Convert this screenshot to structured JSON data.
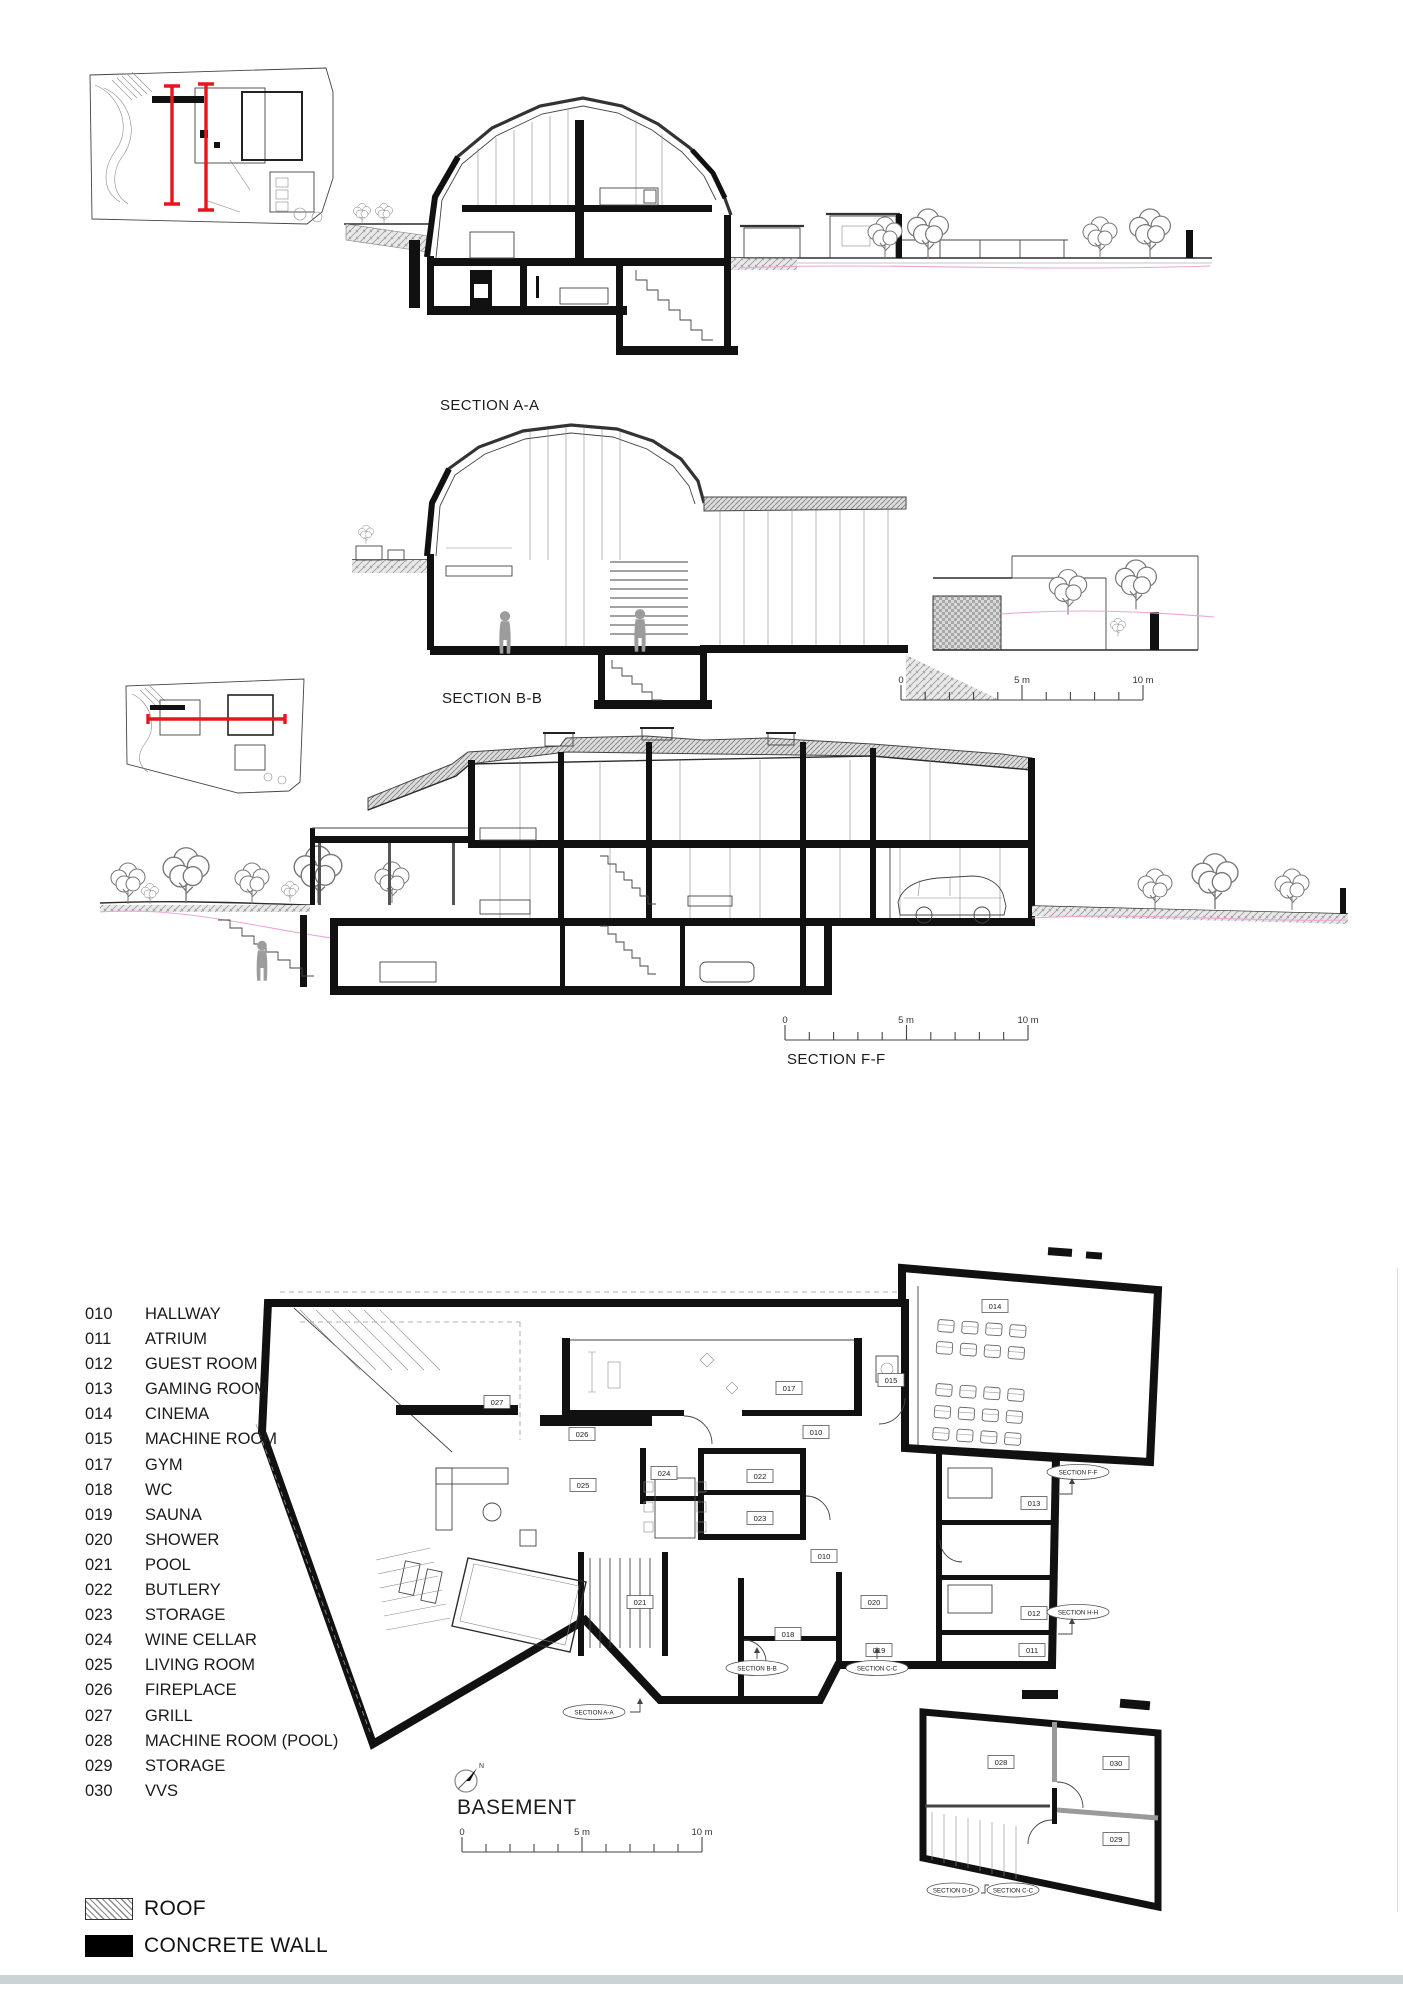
{
  "sections": {
    "aa": {
      "label": "SECTION A-A"
    },
    "bb": {
      "label": "SECTION B-B"
    },
    "ff": {
      "label": "SECTION F-F"
    }
  },
  "scale_bar": {
    "zero": "0",
    "five": "5 m",
    "ten": "10 m"
  },
  "basement": {
    "title": "BASEMENT",
    "north": "N",
    "tags": {
      "t010a": "010",
      "t010b": "010",
      "t011": "011",
      "t012": "012",
      "t013": "013",
      "t014": "014",
      "t015": "015",
      "t017": "017",
      "t018": "018",
      "t019": "019",
      "t020": "020",
      "t021": "021",
      "t022": "022",
      "t023": "023",
      "t024": "024",
      "t025": "025",
      "t026": "026",
      "t027": "027",
      "t028": "028",
      "t029": "029",
      "t030": "030"
    },
    "markers": {
      "ff": "SECTION F-F",
      "hh": "SECTION H-H",
      "aa": "SECTION A-A",
      "bb": "SECTION B-B",
      "cc": "SECTION C-C",
      "dd": "SECTION D-D",
      "cc2": "SECTION C-C"
    }
  },
  "legend": {
    "rooms": [
      {
        "code": "010",
        "name": "HALLWAY"
      },
      {
        "code": "011",
        "name": "ATRIUM"
      },
      {
        "code": "012",
        "name": "GUEST ROOM"
      },
      {
        "code": "013",
        "name": "GAMING ROOM"
      },
      {
        "code": "014",
        "name": "CINEMA"
      },
      {
        "code": "015",
        "name": "MACHINE ROOM"
      },
      {
        "code": "017",
        "name": "GYM"
      },
      {
        "code": "018",
        "name": "WC"
      },
      {
        "code": "019",
        "name": "SAUNA"
      },
      {
        "code": "020",
        "name": "SHOWER"
      },
      {
        "code": "021",
        "name": "POOL"
      },
      {
        "code": "022",
        "name": "BUTLERY"
      },
      {
        "code": "023",
        "name": "STORAGE"
      },
      {
        "code": "024",
        "name": "WINE CELLAR"
      },
      {
        "code": "025",
        "name": "LIVING ROOM"
      },
      {
        "code": "026",
        "name": "FIREPLACE"
      },
      {
        "code": "027",
        "name": "GRILL"
      },
      {
        "code": "028",
        "name": "MACHINE ROOM (POOL)"
      },
      {
        "code": "029",
        "name": "STORAGE"
      },
      {
        "code": "030",
        "name": "VVS"
      }
    ]
  },
  "materials": {
    "roof": "ROOF",
    "concrete": "CONCRETE WALL"
  },
  "colors": {
    "section_marker_red": "#e8141e",
    "terrain_pink": "#eba6d8",
    "concrete_black": "#111111",
    "roof_hatch_grey": "#8a8a8a"
  }
}
